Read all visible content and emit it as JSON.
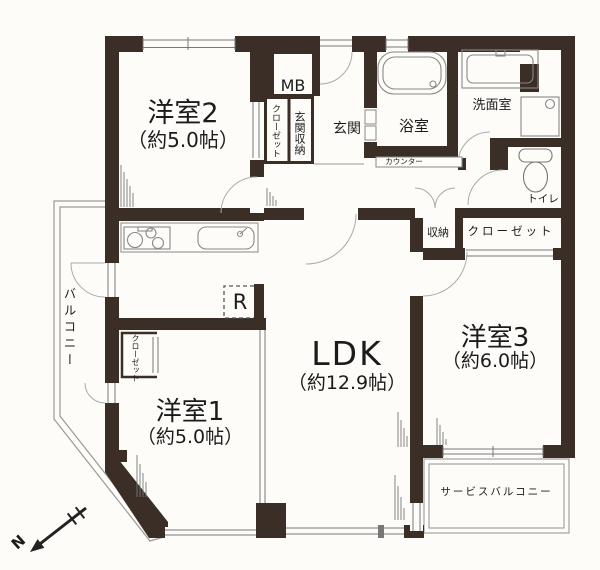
{
  "floorplan": {
    "rooms": {
      "room2": {
        "name": "洋室2",
        "size": "（約5.0帖）"
      },
      "room1": {
        "name": "洋室1",
        "size": "（約5.0帖）"
      },
      "room3": {
        "name": "洋室3",
        "size": "（約6.0帖）"
      },
      "ldk": {
        "name": "LDK",
        "size": "（約12.9帖）"
      }
    },
    "labels": {
      "meter_box": "MB",
      "room2_closet": "クローゼット",
      "entry_storage": "玄関収納",
      "entry": "玄関",
      "bathroom": "浴室",
      "counter": "カウンター",
      "washroom": "洗面室",
      "toilet": "トイレ",
      "storage": "収納",
      "room3_closet": "クローゼット",
      "room1_closet": "クローゼット",
      "refrigerator": "R",
      "balcony": "バルコニー",
      "service_balcony": "サービスバルコニー",
      "compass_north": "N"
    },
    "fixtures": [
      "bathtub",
      "washbasin",
      "washing-machine-pan",
      "toilet",
      "gas-stove",
      "kitchen-sink",
      "refrigerator-space",
      "north-arrow"
    ],
    "colors": {
      "wall": "#3a2e26",
      "thin_line": "#888888",
      "text": "#1b1b1b",
      "paper": "#fdfcf8"
    }
  }
}
